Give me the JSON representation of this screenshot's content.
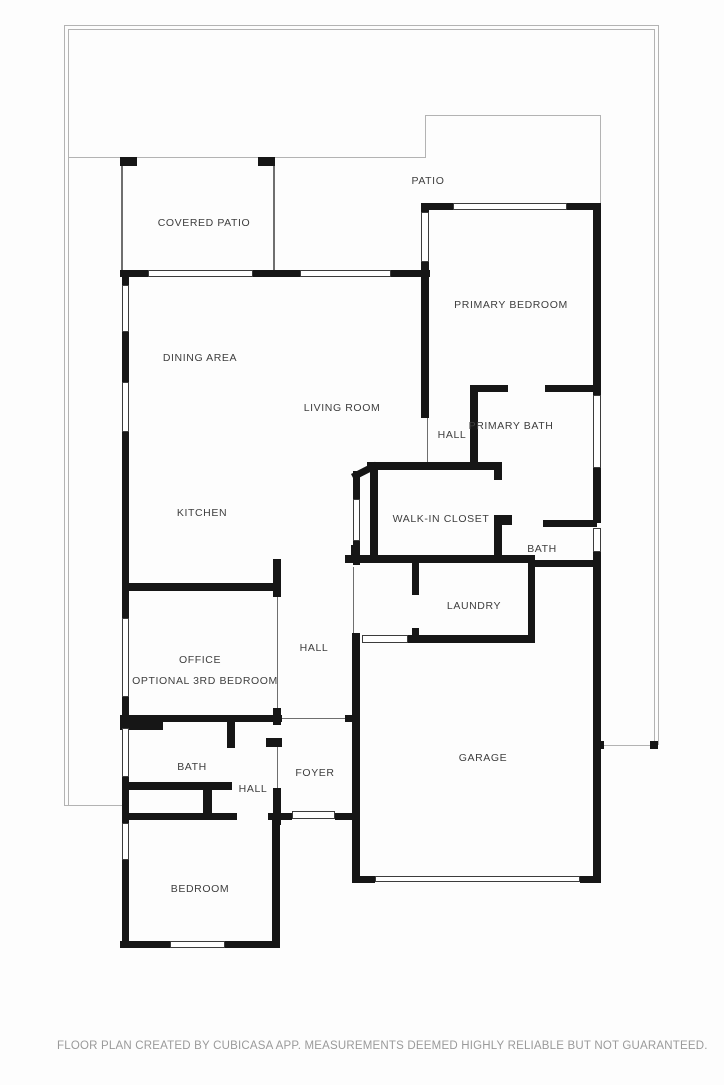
{
  "meta": {
    "app_footer": "FLOOR PLAN CREATED BY CUBICASA APP. MEASUREMENTS DEEMED HIGHLY RELIABLE BUT NOT GUARANTEED.",
    "colors": {
      "wall": "#161616",
      "thin_wall": "#6f6f6f",
      "property_line": "#b3b3b3",
      "label_text": "#3e3e3e",
      "footer_text": "#9a9a9a",
      "background": "#fdfdfd"
    }
  },
  "floorplan": {
    "rooms": [
      {
        "label": "PATIO",
        "x": 428,
        "y": 181
      },
      {
        "label": "COVERED PATIO",
        "x": 204,
        "y": 223
      },
      {
        "label": "PRIMARY BEDROOM",
        "x": 511,
        "y": 305
      },
      {
        "label": "DINING AREA",
        "x": 200,
        "y": 358
      },
      {
        "label": "LIVING ROOM",
        "x": 342,
        "y": 408
      },
      {
        "label": "HALL",
        "x": 452,
        "y": 435
      },
      {
        "label": "PRIMARY BATH",
        "x": 511,
        "y": 426
      },
      {
        "label": "KITCHEN",
        "x": 202,
        "y": 513
      },
      {
        "label": "WALK-IN CLOSET",
        "x": 441,
        "y": 519
      },
      {
        "label": "BATH",
        "x": 542,
        "y": 549
      },
      {
        "label": "LAUNDRY",
        "x": 474,
        "y": 606
      },
      {
        "label": "HALL",
        "x": 314,
        "y": 648
      },
      {
        "label": "OFFICE",
        "x": 200,
        "y": 660
      },
      {
        "label": "OPTIONAL 3RD BEDROOM",
        "x": 205,
        "y": 681
      },
      {
        "label": "GARAGE",
        "x": 483,
        "y": 758
      },
      {
        "label": "BATH",
        "x": 192,
        "y": 767
      },
      {
        "label": "FOYER",
        "x": 315,
        "y": 773
      },
      {
        "label": "HALL",
        "x": 253,
        "y": 789
      },
      {
        "label": "BEDROOM",
        "x": 200,
        "y": 889
      }
    ],
    "walls": [
      {
        "x": 120,
        "y": 270,
        "w": 28,
        "h": 7
      },
      {
        "x": 253,
        "y": 270,
        "w": 47,
        "h": 7
      },
      {
        "x": 391,
        "y": 270,
        "w": 39,
        "h": 7
      },
      {
        "x": 421,
        "y": 203,
        "w": 32,
        "h": 7
      },
      {
        "x": 567,
        "y": 203,
        "w": 34,
        "h": 7
      },
      {
        "x": 421,
        "y": 203,
        "w": 8,
        "h": 9
      },
      {
        "x": 421,
        "y": 262,
        "w": 8,
        "h": 156
      },
      {
        "x": 593,
        "y": 203,
        "w": 8,
        "h": 192
      },
      {
        "x": 593,
        "y": 468,
        "w": 8,
        "h": 55
      },
      {
        "x": 593,
        "y": 552,
        "w": 8,
        "h": 331
      },
      {
        "x": 470,
        "y": 385,
        "w": 38,
        "h": 7
      },
      {
        "x": 545,
        "y": 385,
        "w": 56,
        "h": 7
      },
      {
        "x": 470,
        "y": 388,
        "w": 8,
        "h": 74
      },
      {
        "x": 367,
        "y": 462,
        "w": 135,
        "h": 8
      },
      {
        "x": 370,
        "y": 462,
        "w": 8,
        "h": 95
      },
      {
        "x": 353,
        "y": 471,
        "w": 7,
        "h": 28
      },
      {
        "x": 353,
        "y": 541,
        "w": 7,
        "h": 24
      },
      {
        "x": 494,
        "y": 462,
        "w": 8,
        "h": 18
      },
      {
        "x": 494,
        "y": 515,
        "w": 8,
        "h": 48
      },
      {
        "x": 502,
        "y": 515,
        "w": 10,
        "h": 10
      },
      {
        "x": 345,
        "y": 555,
        "w": 190,
        "h": 8
      },
      {
        "x": 543,
        "y": 520,
        "w": 54,
        "h": 7
      },
      {
        "x": 530,
        "y": 560,
        "w": 71,
        "h": 7
      },
      {
        "x": 412,
        "y": 563,
        "w": 7,
        "h": 32
      },
      {
        "x": 412,
        "y": 628,
        "w": 7,
        "h": 15
      },
      {
        "x": 528,
        "y": 563,
        "w": 7,
        "h": 80
      },
      {
        "x": 408,
        "y": 635,
        "w": 127,
        "h": 8
      },
      {
        "x": 351,
        "y": 545,
        "w": 9,
        "h": 13
      },
      {
        "x": 352,
        "y": 633,
        "w": 8,
        "h": 250
      },
      {
        "x": 352,
        "y": 876,
        "w": 23,
        "h": 7
      },
      {
        "x": 580,
        "y": 876,
        "w": 21,
        "h": 7
      },
      {
        "x": 273,
        "y": 559,
        "w": 8,
        "h": 38
      },
      {
        "x": 273,
        "y": 708,
        "w": 8,
        "h": 17
      },
      {
        "x": 122,
        "y": 583,
        "w": 153,
        "h": 8
      },
      {
        "x": 120,
        "y": 715,
        "w": 162,
        "h": 7
      },
      {
        "x": 120,
        "y": 722,
        "w": 43,
        "h": 8
      },
      {
        "x": 266,
        "y": 738,
        "w": 16,
        "h": 9
      },
      {
        "x": 273,
        "y": 788,
        "w": 8,
        "h": 37
      },
      {
        "x": 345,
        "y": 715,
        "w": 13,
        "h": 7
      },
      {
        "x": 227,
        "y": 718,
        "w": 8,
        "h": 30
      },
      {
        "x": 122,
        "y": 782,
        "w": 110,
        "h": 8
      },
      {
        "x": 203,
        "y": 790,
        "w": 9,
        "h": 25
      },
      {
        "x": 122,
        "y": 813,
        "w": 115,
        "h": 7
      },
      {
        "x": 268,
        "y": 813,
        "w": 24,
        "h": 7
      },
      {
        "x": 335,
        "y": 813,
        "w": 23,
        "h": 7
      },
      {
        "x": 272,
        "y": 820,
        "w": 8,
        "h": 128
      },
      {
        "x": 120,
        "y": 941,
        "w": 50,
        "h": 7
      },
      {
        "x": 225,
        "y": 941,
        "w": 55,
        "h": 7
      },
      {
        "x": 122,
        "y": 270,
        "w": 7,
        "h": 15
      },
      {
        "x": 122,
        "y": 332,
        "w": 7,
        "h": 50
      },
      {
        "x": 122,
        "y": 432,
        "w": 7,
        "h": 186
      },
      {
        "x": 122,
        "y": 697,
        "w": 7,
        "h": 31
      },
      {
        "x": 122,
        "y": 777,
        "w": 7,
        "h": 46
      },
      {
        "x": 122,
        "y": 860,
        "w": 7,
        "h": 88
      },
      {
        "x": 595,
        "y": 741,
        "w": 9,
        "h": 8
      },
      {
        "x": 650,
        "y": 741,
        "w": 8,
        "h": 8
      },
      {
        "x": 120,
        "y": 157,
        "w": 17,
        "h": 9
      },
      {
        "x": 258,
        "y": 157,
        "w": 17,
        "h": 9
      }
    ],
    "diagonals": [
      {
        "x": 351,
        "y": 474,
        "w": 27,
        "h": 7,
        "angle": -27
      }
    ],
    "windows": [
      {
        "x": 148,
        "y": 270,
        "w": 105,
        "h": 7
      },
      {
        "x": 300,
        "y": 270,
        "w": 91,
        "h": 7
      },
      {
        "x": 453,
        "y": 203,
        "w": 114,
        "h": 7
      },
      {
        "x": 421,
        "y": 212,
        "w": 8,
        "h": 50
      },
      {
        "x": 593,
        "y": 395,
        "w": 8,
        "h": 73
      },
      {
        "x": 593,
        "y": 528,
        "w": 8,
        "h": 24
      },
      {
        "x": 353,
        "y": 499,
        "w": 7,
        "h": 42
      },
      {
        "x": 122,
        "y": 285,
        "w": 7,
        "h": 47
      },
      {
        "x": 122,
        "y": 382,
        "w": 7,
        "h": 50
      },
      {
        "x": 122,
        "y": 618,
        "w": 7,
        "h": 79
      },
      {
        "x": 122,
        "y": 728,
        "w": 7,
        "h": 49
      },
      {
        "x": 122,
        "y": 823,
        "w": 7,
        "h": 37
      },
      {
        "x": 170,
        "y": 941,
        "w": 55,
        "h": 7
      },
      {
        "x": 362,
        "y": 635,
        "w": 46,
        "h": 8
      },
      {
        "x": 292,
        "y": 811,
        "w": 43,
        "h": 8
      },
      {
        "x": 375,
        "y": 876,
        "w": 205,
        "h": 6
      }
    ],
    "thin_walls": [
      {
        "x": 121,
        "y": 166,
        "w": 2,
        "h": 104
      },
      {
        "x": 273,
        "y": 166,
        "w": 2,
        "h": 104
      },
      {
        "x": 427,
        "y": 418,
        "w": 1,
        "h": 44
      },
      {
        "x": 353,
        "y": 567,
        "w": 1,
        "h": 66
      },
      {
        "x": 277,
        "y": 597,
        "w": 1,
        "h": 111
      },
      {
        "x": 277,
        "y": 747,
        "w": 1,
        "h": 41
      },
      {
        "x": 282,
        "y": 718,
        "w": 63,
        "h": 1
      }
    ],
    "property_lines": [
      {
        "x": 64,
        "y": 25,
        "w": 594,
        "h": 1
      },
      {
        "x": 68,
        "y": 29,
        "w": 586,
        "h": 1
      },
      {
        "x": 64,
        "y": 25,
        "w": 1,
        "h": 780
      },
      {
        "x": 68,
        "y": 29,
        "w": 1,
        "h": 776
      },
      {
        "x": 658,
        "y": 25,
        "w": 1,
        "h": 720
      },
      {
        "x": 654,
        "y": 29,
        "w": 1,
        "h": 716
      },
      {
        "x": 64,
        "y": 805,
        "w": 58,
        "h": 1
      },
      {
        "x": 601,
        "y": 745,
        "w": 57,
        "h": 1
      },
      {
        "x": 68,
        "y": 157,
        "w": 357,
        "h": 1
      },
      {
        "x": 425,
        "y": 115,
        "w": 1,
        "h": 43
      },
      {
        "x": 425,
        "y": 115,
        "w": 176,
        "h": 1
      },
      {
        "x": 600,
        "y": 115,
        "w": 1,
        "h": 88
      }
    ]
  }
}
